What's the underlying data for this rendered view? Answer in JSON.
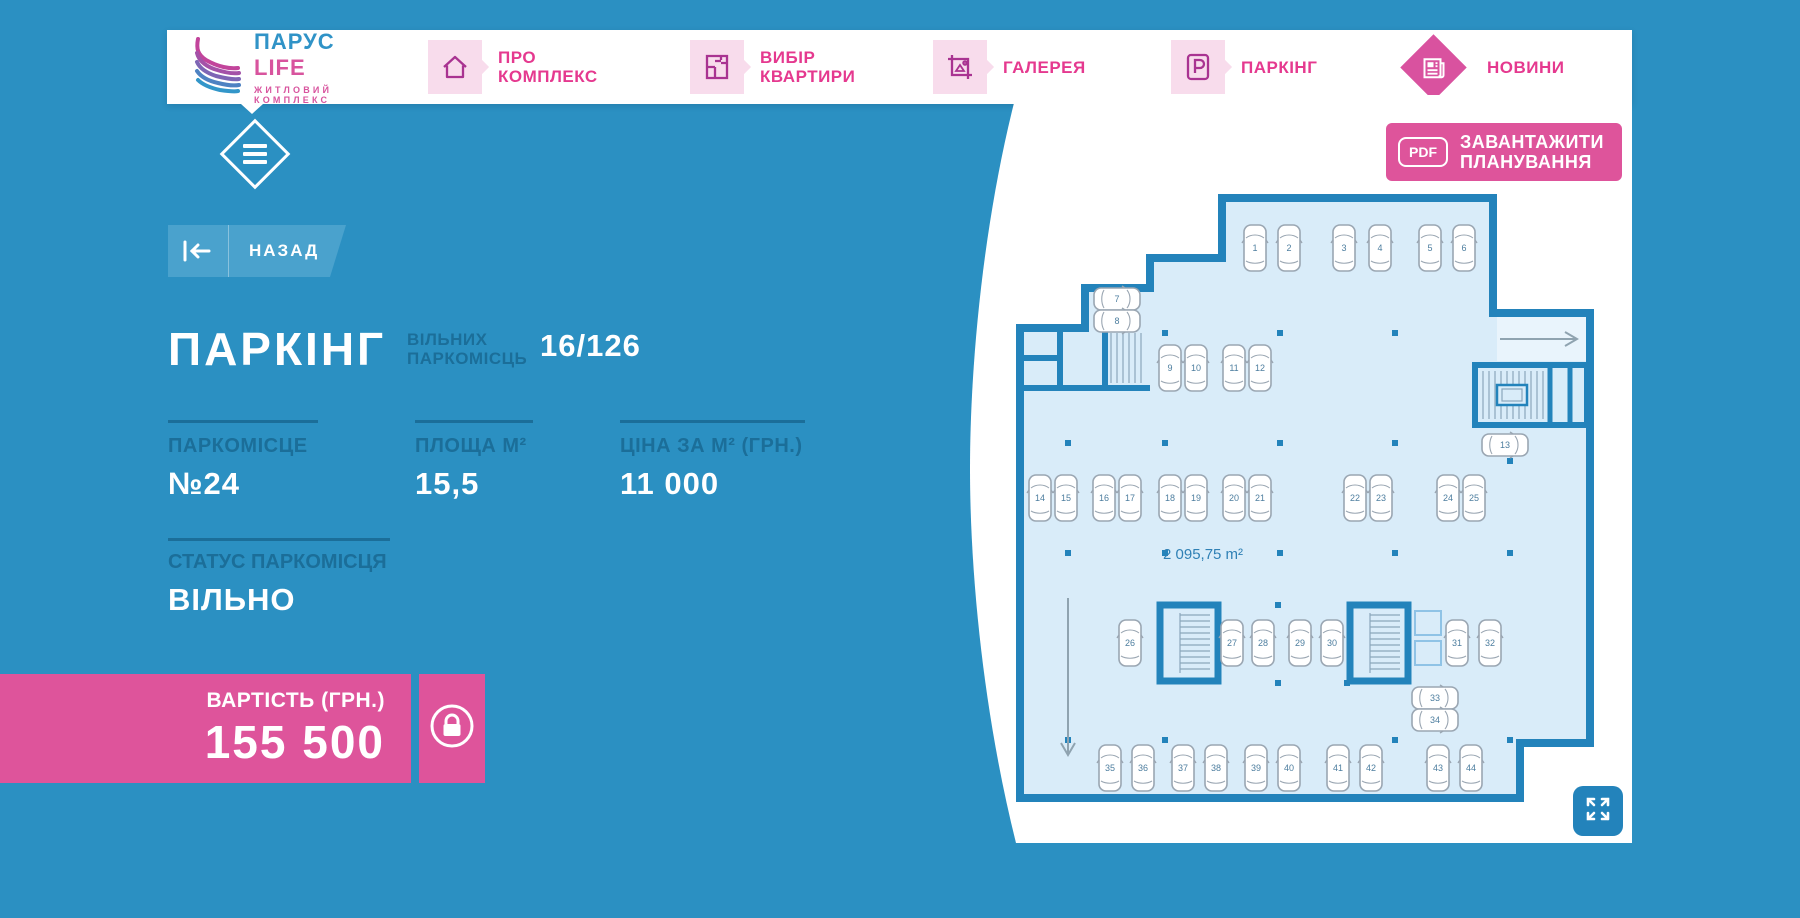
{
  "nav": {
    "logo": {
      "title_word1": "ПАРУС",
      "title_word2": "LIFE",
      "subtitle": "ЖИТЛОВИЙ КОМПЛЕКС"
    },
    "items": [
      {
        "label": "ПРО КОМПЛЕКС",
        "icon": "house-icon"
      },
      {
        "label": "ВИБІР КВАРТИРИ",
        "icon": "floorplan-icon"
      },
      {
        "label": "ГАЛЕРЕЯ",
        "icon": "gallery-icon"
      },
      {
        "label": "ПАРКІНГ",
        "icon": "parking-icon"
      },
      {
        "label": "НОВИНИ",
        "icon": "news-icon"
      }
    ]
  },
  "back_button": {
    "label": "НАЗАД"
  },
  "page": {
    "title": "ПАРКІНГ",
    "free_label": "ВІЛЬНИХ ПАРКОМІСЦЬ",
    "free_value": "16/126",
    "stats": [
      {
        "label": "ПАРКОМІСЦЕ",
        "value": "№24"
      },
      {
        "label": "ПЛОЩА М²",
        "value": "15,5"
      },
      {
        "label": "ЦІНА ЗА М² (ГРН.)",
        "value": "11 000"
      }
    ],
    "status_label": "СТАТУС ПАРКОМІСЦЯ",
    "status_value": "ВІЛЬНО",
    "price_label": "ВАРТІСТЬ (ГРН.)",
    "price_value": "155 500"
  },
  "plan": {
    "download_badge": "PDF",
    "download_label_line1": "ЗАВАНТАЖИТИ",
    "download_label_line2": "ПЛАНУВАННЯ",
    "area_label": "2 095,75 m²",
    "spots": [
      [
        1,
        250,
        55,
        "v"
      ],
      [
        2,
        284,
        55,
        "v"
      ],
      [
        3,
        339,
        55,
        "v"
      ],
      [
        4,
        375,
        55,
        "v"
      ],
      [
        5,
        425,
        55,
        "v"
      ],
      [
        6,
        459,
        55,
        "v"
      ],
      [
        7,
        112,
        106,
        "h"
      ],
      [
        8,
        112,
        128,
        "h"
      ],
      [
        9,
        165,
        175,
        "v"
      ],
      [
        10,
        191,
        175,
        "v"
      ],
      [
        11,
        229,
        175,
        "v"
      ],
      [
        12,
        255,
        175,
        "v"
      ],
      [
        13,
        500,
        252,
        "h"
      ],
      [
        14,
        35,
        305,
        "v"
      ],
      [
        15,
        61,
        305,
        "v"
      ],
      [
        16,
        99,
        305,
        "v"
      ],
      [
        17,
        125,
        305,
        "v"
      ],
      [
        18,
        165,
        305,
        "v"
      ],
      [
        19,
        191,
        305,
        "v"
      ],
      [
        20,
        229,
        305,
        "v"
      ],
      [
        21,
        255,
        305,
        "v"
      ],
      [
        22,
        350,
        305,
        "v"
      ],
      [
        23,
        376,
        305,
        "v"
      ],
      [
        24,
        443,
        305,
        "v"
      ],
      [
        25,
        469,
        305,
        "v"
      ],
      [
        26,
        125,
        450,
        "v"
      ],
      [
        27,
        227,
        450,
        "v"
      ],
      [
        28,
        258,
        450,
        "v"
      ],
      [
        29,
        295,
        450,
        "v"
      ],
      [
        30,
        327,
        450,
        "v"
      ],
      [
        31,
        452,
        450,
        "v"
      ],
      [
        32,
        485,
        450,
        "v"
      ],
      [
        33,
        430,
        505,
        "h"
      ],
      [
        34,
        430,
        527,
        "h"
      ],
      [
        35,
        105,
        575,
        "v"
      ],
      [
        36,
        138,
        575,
        "v"
      ],
      [
        37,
        178,
        575,
        "v"
      ],
      [
        38,
        211,
        575,
        "v"
      ],
      [
        39,
        251,
        575,
        "v"
      ],
      [
        40,
        284,
        575,
        "v"
      ],
      [
        41,
        333,
        575,
        "v"
      ],
      [
        42,
        366,
        575,
        "v"
      ],
      [
        43,
        433,
        575,
        "v"
      ],
      [
        44,
        466,
        575,
        "v"
      ]
    ]
  },
  "colors": {
    "background_blue": "#2b90c2",
    "accent_pink": "#de549b",
    "nav_pink": "#e5398f",
    "icon_magenta": "#a93391",
    "dark_blue_text": "#1b6e99",
    "wall_blue": "#2383bb",
    "floor_blue": "#d9ecf9"
  }
}
